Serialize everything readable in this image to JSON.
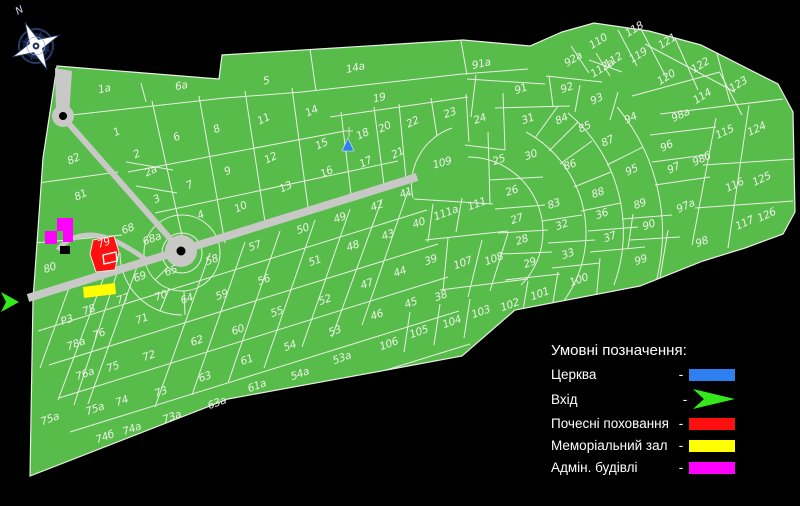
{
  "compass": {
    "label": "N"
  },
  "legend": {
    "title": "Умовні позначення:",
    "rows": [
      {
        "label": "Церква",
        "dash": "-",
        "color": "#2e7ff0",
        "shape": "rect"
      },
      {
        "label": "Вхід",
        "dash": "-",
        "color": "#35e81c",
        "shape": "arrow"
      },
      {
        "label": "Почесні поховання",
        "dash": "-",
        "color": "#ff0f0f",
        "shape": "rect"
      },
      {
        "label": "Меморіальний зал",
        "dash": "-",
        "color": "#ffff00",
        "shape": "rect"
      },
      {
        "label": "Адмін. будівлі",
        "dash": "-",
        "color": "#ff00ff",
        "shape": "rect"
      }
    ]
  },
  "map": {
    "colors": {
      "ground": "#58bc4b",
      "line": "#e8efe3",
      "road": "#c8c8c6",
      "dot": "#000000",
      "church": "#2e7ff0",
      "cross": "#d9e3d7",
      "entrance": "#35e81c",
      "honor": "#ff0f0f",
      "memorial": "#ffff00",
      "admin": "#ff00ff",
      "black_building": "#000000"
    },
    "plots": [
      {
        "t": "1a",
        "x": 105,
        "y": 92,
        "r": -12
      },
      {
        "t": "6a",
        "x": 182,
        "y": 89,
        "r": -12
      },
      {
        "t": "5",
        "x": 267,
        "y": 84,
        "r": -12
      },
      {
        "t": "14a",
        "x": 356,
        "y": 71,
        "r": -12
      },
      {
        "t": "91a",
        "x": 482,
        "y": 67,
        "r": -12
      },
      {
        "t": "19",
        "x": 380,
        "y": 101,
        "r": -12
      },
      {
        "t": "1",
        "x": 118,
        "y": 135,
        "r": -25
      },
      {
        "t": "2",
        "x": 138,
        "y": 157,
        "r": -25
      },
      {
        "t": "2a",
        "x": 152,
        "y": 174,
        "r": -25
      },
      {
        "t": "3",
        "x": 158,
        "y": 202,
        "r": -25
      },
      {
        "t": "4",
        "x": 202,
        "y": 218,
        "r": -25
      },
      {
        "t": "6",
        "x": 178,
        "y": 140,
        "r": -25
      },
      {
        "t": "8",
        "x": 218,
        "y": 132,
        "r": -25
      },
      {
        "t": "11",
        "x": 265,
        "y": 122,
        "r": -25
      },
      {
        "t": "14",
        "x": 313,
        "y": 114,
        "r": -25
      },
      {
        "t": "9",
        "x": 229,
        "y": 174,
        "r": -25
      },
      {
        "t": "12",
        "x": 272,
        "y": 161,
        "r": -25
      },
      {
        "t": "15",
        "x": 323,
        "y": 147,
        "r": -25
      },
      {
        "t": "16",
        "x": 328,
        "y": 175,
        "r": -25
      },
      {
        "t": "17",
        "x": 367,
        "y": 165,
        "r": -25
      },
      {
        "t": "18",
        "x": 364,
        "y": 137,
        "r": -25
      },
      {
        "t": "7",
        "x": 191,
        "y": 188,
        "r": -25
      },
      {
        "t": "10",
        "x": 242,
        "y": 210,
        "r": -25
      },
      {
        "t": "13",
        "x": 287,
        "y": 190,
        "r": -25
      },
      {
        "t": "20",
        "x": 386,
        "y": 130,
        "r": -25
      },
      {
        "t": "21",
        "x": 399,
        "y": 156,
        "r": -25
      },
      {
        "t": "22",
        "x": 414,
        "y": 125,
        "r": -25
      },
      {
        "t": "23",
        "x": 451,
        "y": 116
      },
      {
        "t": "24",
        "x": 481,
        "y": 122
      },
      {
        "t": "25",
        "x": 500,
        "y": 163
      },
      {
        "t": "26",
        "x": 513,
        "y": 194
      },
      {
        "t": "27",
        "x": 518,
        "y": 222
      },
      {
        "t": "28",
        "x": 523,
        "y": 243
      },
      {
        "t": "29",
        "x": 531,
        "y": 266
      },
      {
        "t": "30",
        "x": 532,
        "y": 158
      },
      {
        "t": "31",
        "x": 529,
        "y": 122
      },
      {
        "t": "82",
        "x": 75,
        "y": 162,
        "r": -25
      },
      {
        "t": "81",
        "x": 82,
        "y": 198,
        "r": -25
      },
      {
        "t": "80",
        "x": 51,
        "y": 271
      },
      {
        "t": "79",
        "x": 105,
        "y": 246
      },
      {
        "t": "68",
        "x": 129,
        "y": 232
      },
      {
        "t": "68a",
        "x": 153,
        "y": 242
      },
      {
        "t": "65",
        "x": 172,
        "y": 274
      },
      {
        "t": "69",
        "x": 141,
        "y": 280
      },
      {
        "t": "70",
        "x": 162,
        "y": 299
      },
      {
        "t": "64",
        "x": 188,
        "y": 302
      },
      {
        "t": "57",
        "x": 256,
        "y": 249
      },
      {
        "t": "58",
        "x": 213,
        "y": 263
      },
      {
        "t": "59",
        "x": 223,
        "y": 298
      },
      {
        "t": "56",
        "x": 265,
        "y": 283
      },
      {
        "t": "50",
        "x": 304,
        "y": 232
      },
      {
        "t": "51",
        "x": 316,
        "y": 264
      },
      {
        "t": "52",
        "x": 326,
        "y": 303
      },
      {
        "t": "49",
        "x": 341,
        "y": 221
      },
      {
        "t": "48",
        "x": 354,
        "y": 249
      },
      {
        "t": "47",
        "x": 368,
        "y": 287
      },
      {
        "t": "46",
        "x": 378,
        "y": 318
      },
      {
        "t": "53",
        "x": 336,
        "y": 334
      },
      {
        "t": "55",
        "x": 278,
        "y": 315
      },
      {
        "t": "54",
        "x": 291,
        "y": 349
      },
      {
        "t": "54a",
        "x": 301,
        "y": 377
      },
      {
        "t": "53a",
        "x": 343,
        "y": 361
      },
      {
        "t": "60",
        "x": 239,
        "y": 333
      },
      {
        "t": "61",
        "x": 248,
        "y": 363
      },
      {
        "t": "61a",
        "x": 258,
        "y": 389
      },
      {
        "t": "62",
        "x": 198,
        "y": 344
      },
      {
        "t": "63",
        "x": 206,
        "y": 380
      },
      {
        "t": "63a",
        "x": 218,
        "y": 406
      },
      {
        "t": "41",
        "x": 407,
        "y": 196
      },
      {
        "t": "42",
        "x": 378,
        "y": 209
      },
      {
        "t": "43",
        "x": 389,
        "y": 238
      },
      {
        "t": "44",
        "x": 401,
        "y": 275
      },
      {
        "t": "45",
        "x": 412,
        "y": 306
      },
      {
        "t": "40",
        "x": 420,
        "y": 226
      },
      {
        "t": "39",
        "x": 432,
        "y": 263
      },
      {
        "t": "38",
        "x": 442,
        "y": 299
      },
      {
        "t": "109",
        "x": 443,
        "y": 166,
        "r": -15,
        "s": 13
      },
      {
        "t": "111",
        "x": 478,
        "y": 207
      },
      {
        "t": "111a",
        "x": 447,
        "y": 216
      },
      {
        "t": "107",
        "x": 464,
        "y": 266
      },
      {
        "t": "108",
        "x": 495,
        "y": 262
      },
      {
        "t": "106",
        "x": 390,
        "y": 347
      },
      {
        "t": "105",
        "x": 420,
        "y": 335
      },
      {
        "t": "104",
        "x": 453,
        "y": 325
      },
      {
        "t": "103",
        "x": 482,
        "y": 315
      },
      {
        "t": "102",
        "x": 511,
        "y": 308
      },
      {
        "t": "101",
        "x": 541,
        "y": 297
      },
      {
        "t": "100",
        "x": 580,
        "y": 283
      },
      {
        "t": "83",
        "x": 555,
        "y": 207
      },
      {
        "t": "32",
        "x": 563,
        "y": 228
      },
      {
        "t": "33",
        "x": 569,
        "y": 257
      },
      {
        "t": "36",
        "x": 603,
        "y": 217
      },
      {
        "t": "37",
        "x": 611,
        "y": 240
      },
      {
        "t": "86",
        "x": 571,
        "y": 168,
        "s": 13
      },
      {
        "t": "88",
        "x": 599,
        "y": 196
      },
      {
        "t": "89",
        "x": 641,
        "y": 207
      },
      {
        "t": "90",
        "x": 650,
        "y": 228
      },
      {
        "t": "98",
        "x": 703,
        "y": 245
      },
      {
        "t": "99",
        "x": 642,
        "y": 263
      },
      {
        "t": "91",
        "x": 522,
        "y": 92
      },
      {
        "t": "92",
        "x": 568,
        "y": 91
      },
      {
        "t": "92a",
        "x": 575,
        "y": 62,
        "r": -32
      },
      {
        "t": "93",
        "x": 598,
        "y": 102,
        "r": -25
      },
      {
        "t": "94",
        "x": 632,
        "y": 121,
        "r": -25
      },
      {
        "t": "84",
        "x": 563,
        "y": 122,
        "r": -25
      },
      {
        "t": "85",
        "x": 586,
        "y": 130,
        "r": -25
      },
      {
        "t": "87",
        "x": 609,
        "y": 144,
        "r": -25
      },
      {
        "t": "95",
        "x": 633,
        "y": 173,
        "r": -25
      },
      {
        "t": "96",
        "x": 668,
        "y": 149,
        "r": -25
      },
      {
        "t": "97",
        "x": 675,
        "y": 171,
        "r": -25
      },
      {
        "t": "97a",
        "x": 687,
        "y": 209,
        "r": -25
      },
      {
        "t": "98a",
        "x": 682,
        "y": 118,
        "r": -25
      },
      {
        "t": "98б",
        "x": 703,
        "y": 162,
        "r": -25
      },
      {
        "t": "110",
        "x": 600,
        "y": 44,
        "r": -32
      },
      {
        "t": "112a",
        "x": 604,
        "y": 71,
        "r": -32
      },
      {
        "t": "112",
        "x": 615,
        "y": 63,
        "r": -32,
        "s": 7
      },
      {
        "t": "118",
        "x": 636,
        "y": 32,
        "r": -32
      },
      {
        "t": "119",
        "x": 640,
        "y": 58,
        "r": -32
      },
      {
        "t": "121",
        "x": 669,
        "y": 44,
        "r": -32
      },
      {
        "t": "120",
        "x": 668,
        "y": 80,
        "r": -32
      },
      {
        "t": "122",
        "x": 702,
        "y": 68,
        "r": -32
      },
      {
        "t": "123",
        "x": 740,
        "y": 87,
        "r": -32
      },
      {
        "t": "114",
        "x": 704,
        "y": 99,
        "r": -32
      },
      {
        "t": "115",
        "x": 726,
        "y": 135,
        "r": -25
      },
      {
        "t": "116",
        "x": 736,
        "y": 188,
        "r": -25
      },
      {
        "t": "117",
        "x": 746,
        "y": 226,
        "r": -25
      },
      {
        "t": "124",
        "x": 758,
        "y": 132,
        "r": -25
      },
      {
        "t": "125",
        "x": 763,
        "y": 182,
        "r": -25
      },
      {
        "t": "126",
        "x": 768,
        "y": 218,
        "r": -25
      },
      {
        "t": "71",
        "x": 143,
        "y": 322
      },
      {
        "t": "72",
        "x": 150,
        "y": 359
      },
      {
        "t": "73",
        "x": 162,
        "y": 395
      },
      {
        "t": "73a",
        "x": 173,
        "y": 420
      },
      {
        "t": "74",
        "x": 123,
        "y": 404
      },
      {
        "t": "74a",
        "x": 133,
        "y": 432
      },
      {
        "t": "74б",
        "x": 106,
        "y": 440
      },
      {
        "t": "75",
        "x": 114,
        "y": 370
      },
      {
        "t": "75a",
        "x": 51,
        "y": 422,
        "s": 12
      },
      {
        "t": "75a",
        "x": 96,
        "y": 412,
        "s": 9
      },
      {
        "t": "76",
        "x": 100,
        "y": 337
      },
      {
        "t": "76a",
        "x": 86,
        "y": 377
      },
      {
        "t": "77",
        "x": 124,
        "y": 302
      },
      {
        "t": "78",
        "x": 90,
        "y": 313
      },
      {
        "t": "78a",
        "x": 77,
        "y": 347
      },
      {
        "t": "Р3",
        "x": 68,
        "y": 323
      }
    ]
  }
}
